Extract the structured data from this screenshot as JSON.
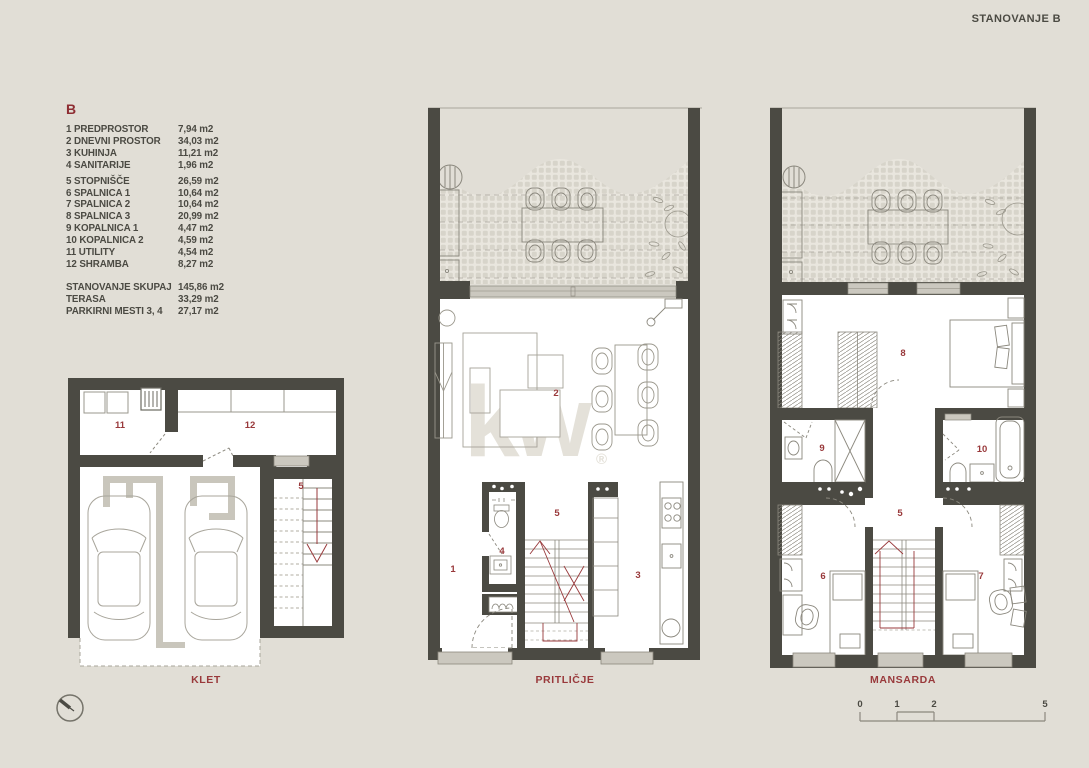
{
  "page": {
    "title": "STANOVANJE B",
    "background": "#e1ded6",
    "wall_color": "#4b4a43",
    "accent_red": "#99393b",
    "heading_red": "#8e2d33",
    "text_color": "#4b4a43"
  },
  "legend": {
    "heading": "B",
    "items": [
      {
        "label": "1 PREDPROSTOR",
        "area": "7,94 m2"
      },
      {
        "label": "2 DNEVNI PROSTOR",
        "area": "34,03 m2"
      },
      {
        "label": "3 KUHINJA",
        "area": "11,21 m2"
      },
      {
        "label": "4 SANITARIJE",
        "area": "1,96 m2"
      },
      {
        "label": "5 STOPNIŠČE",
        "area": "26,59 m2"
      },
      {
        "label": "6 SPALNICA 1",
        "area": "10,64 m2"
      },
      {
        "label": "7 SPALNICA 2",
        "area": "10,64 m2"
      },
      {
        "label": "8 SPALNICA 3",
        "area": "20,99 m2"
      },
      {
        "label": "9 KOPALNICA 1",
        "area": "4,47 m2"
      },
      {
        "label": "10 KOPALNICA 2",
        "area": "4,59 m2"
      },
      {
        "label": "11 UTILITY",
        "area": "4,54 m2"
      },
      {
        "label": "12 SHRAMBA",
        "area": "8,27 m2"
      }
    ],
    "totals": [
      {
        "label": "STANOVANJE  SKUPAJ",
        "area": "145,86 m2"
      },
      {
        "label": "TERASA",
        "area": "33,29 m2"
      },
      {
        "label": "PARKIRNI MESTI  3, 4",
        "area": "27,17 m2"
      }
    ]
  },
  "plans": {
    "klet": {
      "label": "KLET",
      "rooms": {
        "r11": "11",
        "r12": "12",
        "r5": "5"
      }
    },
    "pritlicje": {
      "label": "PRITLIČJE",
      "rooms": {
        "r1": "1",
        "r2": "2",
        "r3": "3",
        "r4": "4",
        "r5": "5"
      }
    },
    "mansarda": {
      "label": "MANSARDA",
      "rooms": {
        "r5": "5",
        "r6": "6",
        "r7": "7",
        "r8": "8",
        "r9": "9",
        "r10": "10"
      }
    }
  },
  "watermark": {
    "text": "kw",
    "reg": "®"
  },
  "scale_bar": {
    "ticks": [
      "0",
      "1",
      "2",
      "5"
    ]
  }
}
